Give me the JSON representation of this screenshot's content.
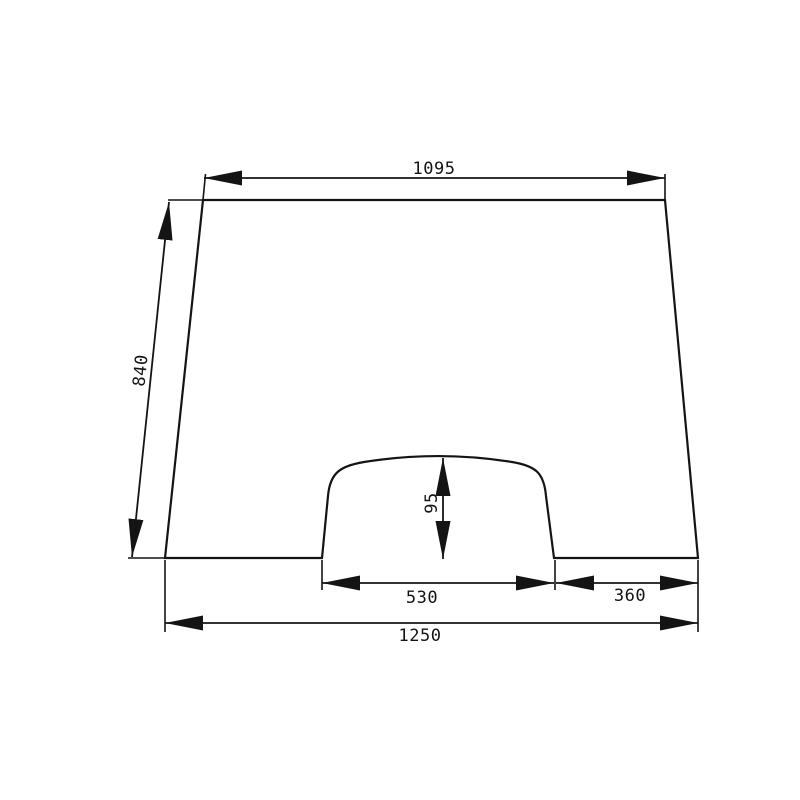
{
  "drawing": {
    "type": "dimensioned technical drawing",
    "subject": "trapezoidal windshield glass panel with rounded bottom-center cutout",
    "background_color": "#ffffff",
    "line_color": "#141414",
    "dimensions": {
      "top_width": "1095",
      "side_length": "840",
      "cutout_height": "95",
      "cutout_width": "530",
      "bottom_right_segment": "360",
      "bottom_width": "1250"
    }
  }
}
